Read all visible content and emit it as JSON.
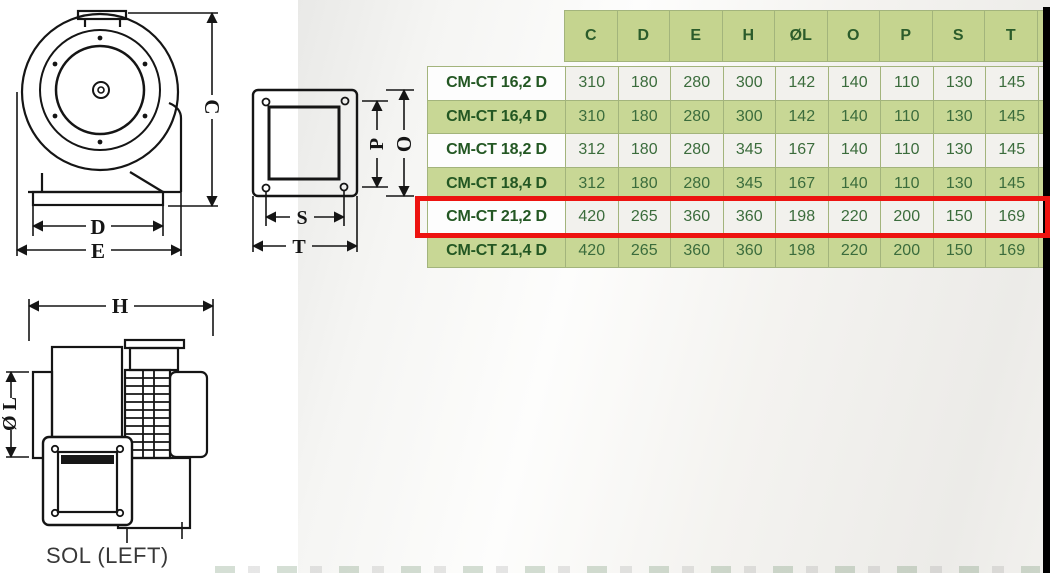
{
  "table": {
    "header_columns": [
      "C",
      "D",
      "E",
      "H",
      "ØL",
      "O",
      "P",
      "S",
      "T"
    ],
    "rows": [
      {
        "model": "CM-CT 16,2 D",
        "values": [
          "310",
          "180",
          "280",
          "300",
          "142",
          "140",
          "110",
          "130",
          "145"
        ],
        "highlighted": false
      },
      {
        "model": "CM-CT 16,4 D",
        "values": [
          "310",
          "180",
          "280",
          "300",
          "142",
          "140",
          "110",
          "130",
          "145"
        ],
        "highlighted": false
      },
      {
        "model": "CM-CT 18,2 D",
        "values": [
          "312",
          "180",
          "280",
          "345",
          "167",
          "140",
          "110",
          "130",
          "145"
        ],
        "highlighted": false
      },
      {
        "model": "CM-CT 18,4 D",
        "values": [
          "312",
          "180",
          "280",
          "345",
          "167",
          "140",
          "110",
          "130",
          "145"
        ],
        "highlighted": false
      },
      {
        "model": "CM-CT 21,2 D",
        "values": [
          "420",
          "265",
          "360",
          "360",
          "198",
          "220",
          "200",
          "150",
          "169"
        ],
        "highlighted": true
      },
      {
        "model": "CM-CT 21,4 D",
        "values": [
          "420",
          "265",
          "360",
          "360",
          "198",
          "220",
          "200",
          "150",
          "169"
        ],
        "highlighted": false
      }
    ],
    "note": "rightmost tenth column cut off by image edge"
  },
  "drawings": {
    "front_view": {
      "dims": {
        "c": "C",
        "d": "D",
        "e": "E"
      }
    },
    "flange_view": {
      "dims": {
        "p": "P",
        "o": "O",
        "s": "S",
        "t": "T"
      }
    },
    "side_view": {
      "dims": {
        "h": "H",
        "ol": "Ø L"
      },
      "caption": "SOL (LEFT)"
    }
  },
  "colors": {
    "green_cell": "#c8d795",
    "header_cell": "#c5d48f",
    "light_cell": "#f2f1ed",
    "table_border": "#a3b47c",
    "text_green": "#2b5c2b",
    "highlight_red": "#ed1310",
    "edge_bar_black": "#000000"
  }
}
